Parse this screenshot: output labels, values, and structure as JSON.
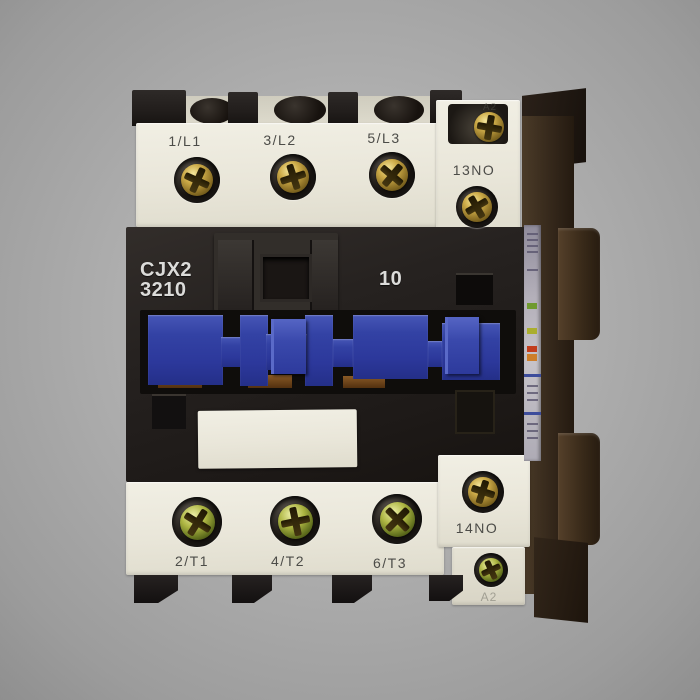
{
  "product": {
    "model_line1": "CJX2",
    "model_line2": "3210",
    "aux_contact_code": "10"
  },
  "terminals": {
    "line": [
      "1/L1",
      "3/L2",
      "5/L3"
    ],
    "load": [
      "2/T1",
      "4/T2",
      "6/T3"
    ],
    "aux_no_top": "13NO",
    "aux_no_bottom": "14NO",
    "coil_top": "A2",
    "coil_bottom": "A2"
  },
  "colors": {
    "background_gray": "#a9a9a9",
    "housing_black": "#211d1a",
    "terminal_cream": "#eae7da",
    "actuator_blue": "#3240a2",
    "screw_brass": "#c2a646",
    "screw_zinc_green": "#a8b040",
    "side_housing_brown": "#3e2f1f",
    "side_label_gray": "#b3afb9",
    "print_white": "#dcdcda",
    "print_dark": "#4c4c48"
  }
}
